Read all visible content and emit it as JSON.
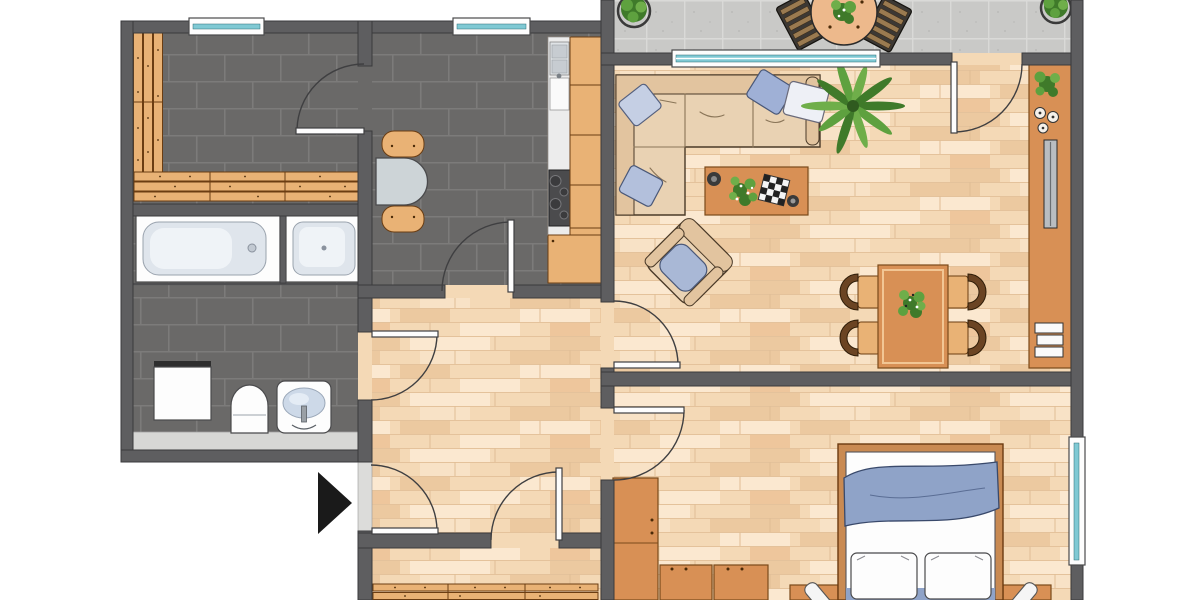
{
  "title": "Apartment floor plan, top-down view, no text labels",
  "colors": {
    "wall": "#5e5e60",
    "dark_tile": "#6a6968",
    "tile_grout": "#7c7b7a",
    "wood_floor": "#f4d9b6",
    "wood_floor_light": "#fbe8d0",
    "wood_floor_dark": "#ecc9a0",
    "balcony_tile": "#c9c9c7",
    "window_glass": "#7fc9d4",
    "furniture_wood": "#e9b275",
    "furniture_wood_edge": "#6b3d12",
    "furniture_tan": "#d89055",
    "sofa_beige": "#e9d2b3",
    "textile_blue": "#9fb0d6",
    "textile_blue_light": "#c5cfe4",
    "blanket_blue": "#8fa3c8",
    "plant_green": "#4e8f35",
    "metal_gray": "#b9bdc1",
    "arrow_black": "#1a1a1a"
  },
  "rooms": [
    {
      "name": "sauna-room",
      "floor": "dark-tile",
      "items": [
        "l-shaped-wood-bench-slats",
        "window",
        "door-to-kitchen"
      ]
    },
    {
      "name": "bathroom",
      "floor": "dark-tile",
      "items": [
        "bathtub",
        "shower",
        "washing-machine",
        "toilet",
        "sink",
        "counter-shelf",
        "door-to-hallway"
      ]
    },
    {
      "name": "kitchen",
      "floor": "dark-tile",
      "items": [
        "counter-with-sink-and-stove",
        "round-table",
        "two-chairs",
        "window",
        "door-to-hallway"
      ]
    },
    {
      "name": "hallway",
      "floor": "wood",
      "items": [
        "entrance-door",
        "doors-to-all-rooms"
      ]
    },
    {
      "name": "living-room",
      "floor": "wood",
      "items": [
        "corner-sofa",
        "four-pillows",
        "coffee-table",
        "potted-palm",
        "armchair",
        "dining-table",
        "four-chairs",
        "sideboard",
        "tv",
        "books"
      ]
    },
    {
      "name": "bedroom",
      "floor": "wood",
      "items": [
        "double-bed",
        "two-pillows",
        "blanket",
        "two-nightstands",
        "two-lamps",
        "wardrobe-units",
        "window"
      ]
    },
    {
      "name": "lower-room",
      "floor": "wood",
      "items": [
        "radiator-slats"
      ],
      "note": "cut off at bottom edge"
    },
    {
      "name": "balcony",
      "floor": "stone-tile",
      "items": [
        "round-table-with-plant",
        "two-slatted-chairs",
        "two-potted-plants",
        "wide-window",
        "door-to-living-room"
      ],
      "note": "cut off at top edge"
    }
  ],
  "windows_count": 4,
  "doors_count": 8,
  "entrance_marker": {
    "shape": "black-triangle-arrow",
    "direction": "right"
  }
}
